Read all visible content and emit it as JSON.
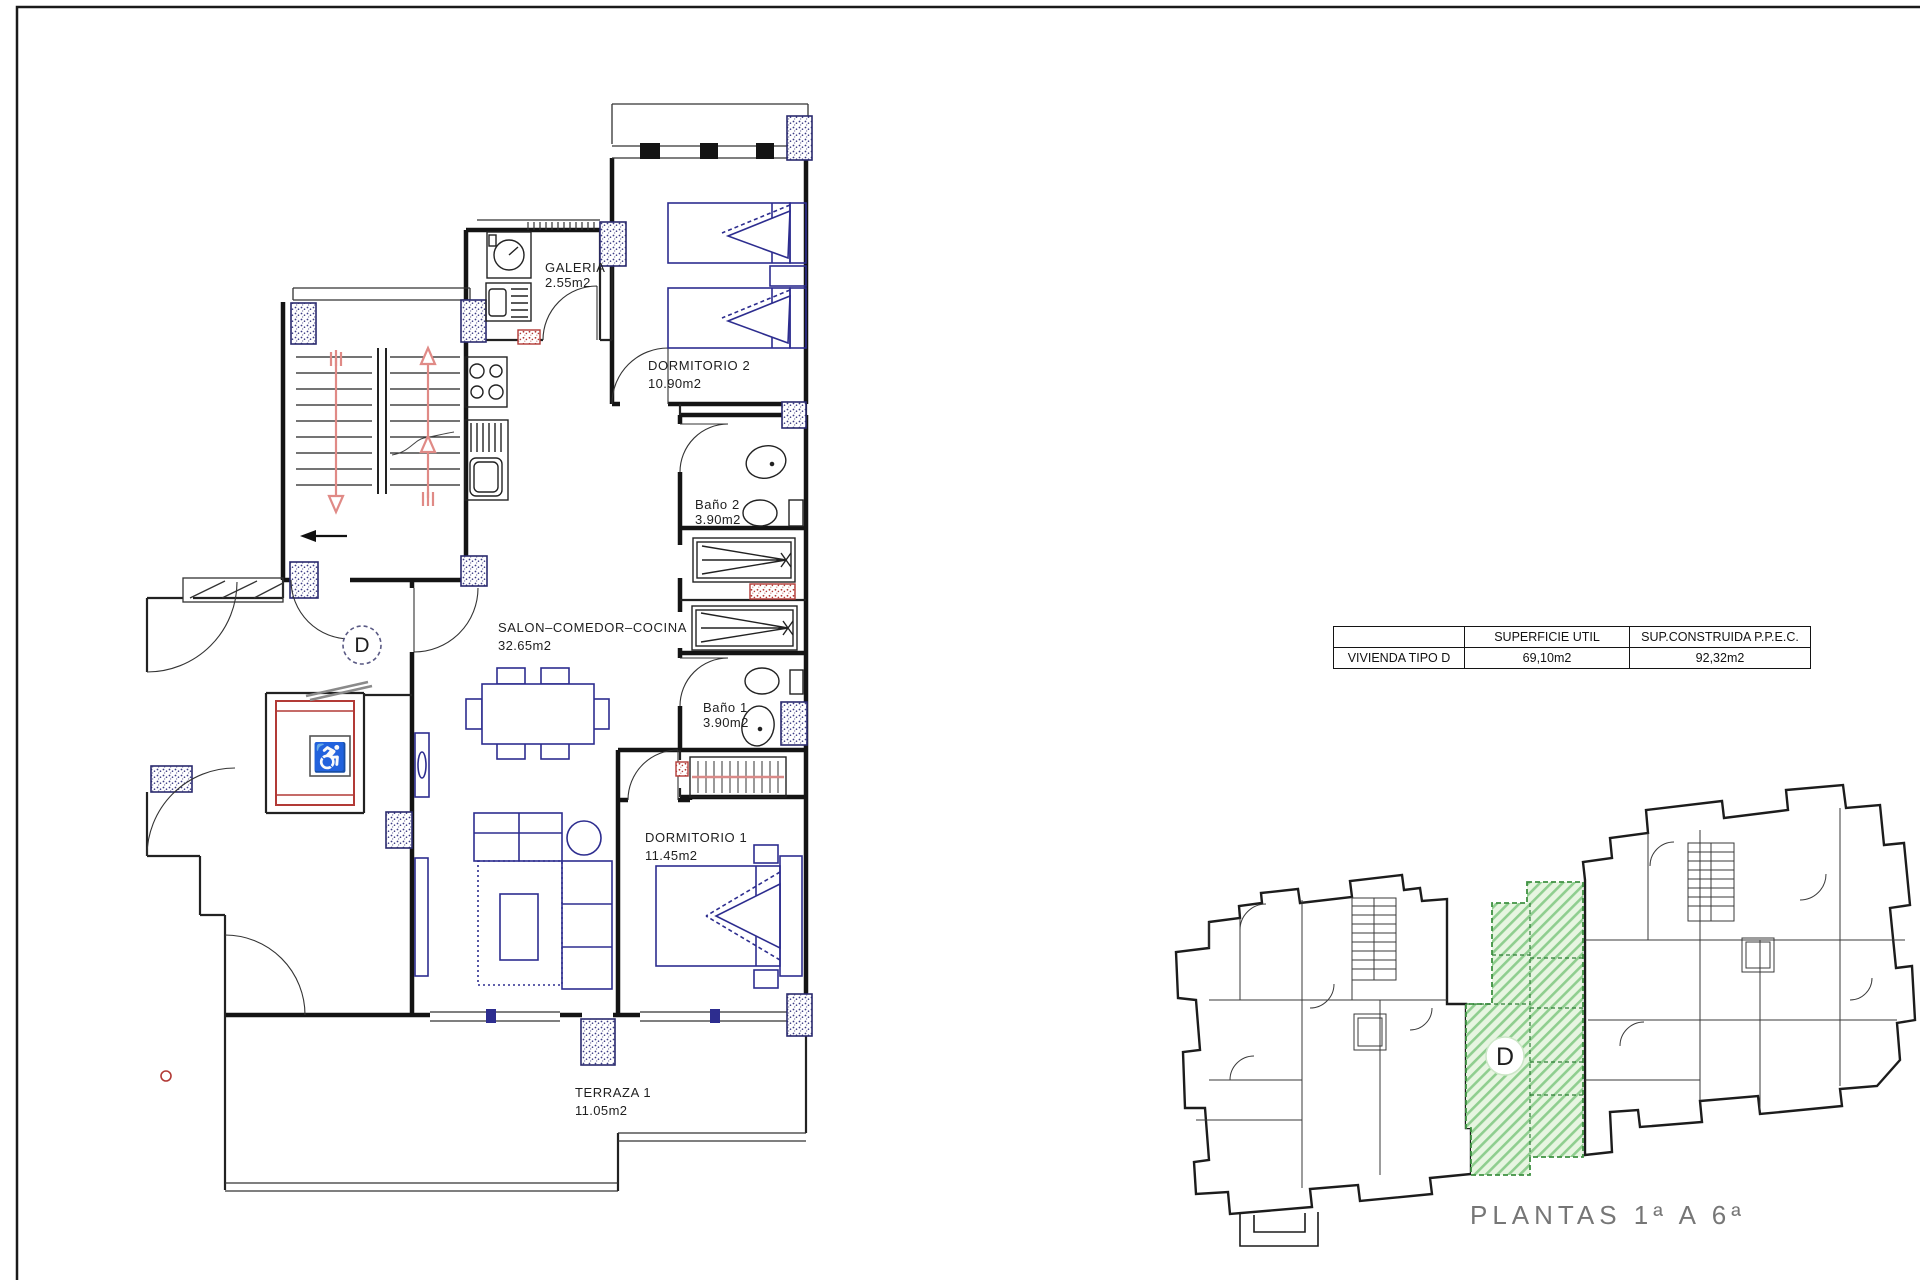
{
  "floor_plan": {
    "unit_letter": "D",
    "rooms": {
      "galeria": {
        "name": "GALERIA",
        "area": "2.55m2"
      },
      "dormitorio2": {
        "name": "DORMITORIO 2",
        "area": "10.90m2"
      },
      "bano2": {
        "name": "Baño 2",
        "area": "3.90m2"
      },
      "salon": {
        "name": "SALON–COMEDOR–COCINA",
        "area": "32.65m2"
      },
      "bano1": {
        "name": "Baño 1",
        "area": "3.90m2"
      },
      "dormitorio1": {
        "name": "DORMITORIO 1",
        "area": "11.45m2"
      },
      "terraza": {
        "name": "TERRAZA 1",
        "area": "11.05m2"
      }
    }
  },
  "summary_table": {
    "header": {
      "c0": "",
      "c1": "SUPERFICIE UTIL",
      "c2": "SUP.CONSTRUIDA P.P.E.C."
    },
    "row": {
      "c0": "VIVIENDA TIPO D",
      "c1": "69,10m2",
      "c2": "92,32m2"
    }
  },
  "key_plan": {
    "unit_letter": "D",
    "caption": "PLANTAS 1ª A 6ª"
  },
  "icons": {
    "wheelchair_glyph": "♿"
  },
  "colors": {
    "wall": "#141414",
    "furniture_blue": "#2d2d8f",
    "accent_red": "#b23a36",
    "stair_arrow_pink": "#e08a86",
    "green_fill": "#e7f5e1",
    "green_hatch": "#8fce8f",
    "green_outline": "#3f9142",
    "caption_gray": "#767676"
  }
}
